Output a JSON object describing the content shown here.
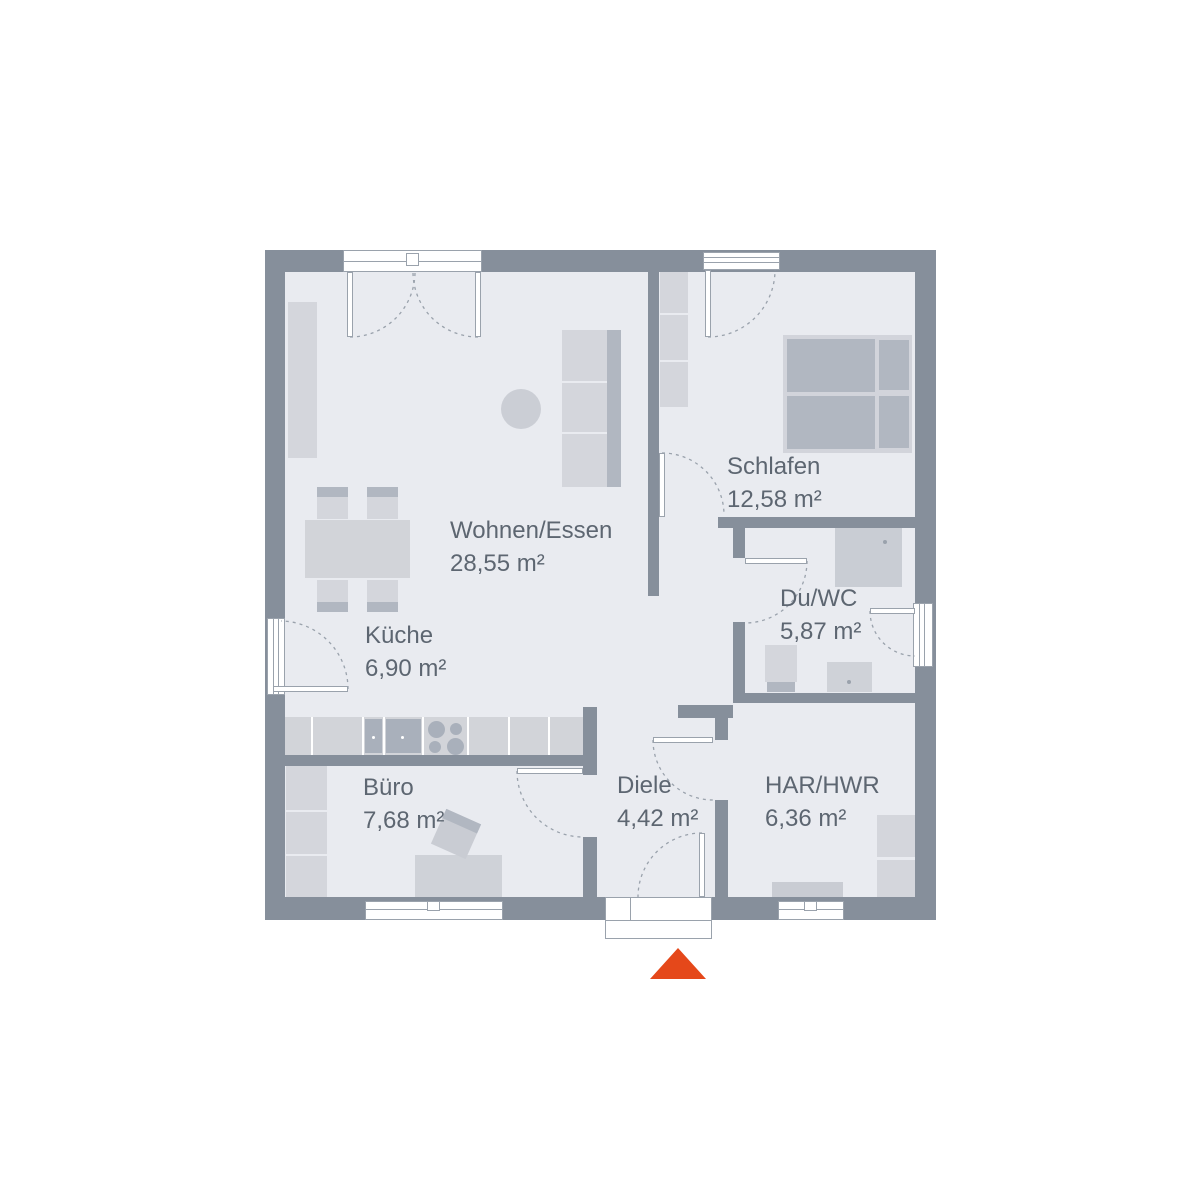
{
  "rooms": {
    "wohnen": {
      "name": "Wohnen/Essen",
      "area": "28,55 m²"
    },
    "schlafen": {
      "name": "Schlafen",
      "area": "12,58 m²"
    },
    "duwc": {
      "name": "Du/WC",
      "area": "5,87 m²"
    },
    "kueche": {
      "name": "Küche",
      "area": "6,90 m²"
    },
    "buero": {
      "name": "Büro",
      "area": "7,68 m²"
    },
    "diele": {
      "name": "Diele",
      "area": "4,42 m²"
    },
    "har": {
      "name": "HAR/HWR",
      "area": "6,36 m²"
    }
  },
  "entrance_marker": {
    "icon": "triangle-up-icon",
    "color": "#e5481a"
  },
  "colors": {
    "wall": "#868f9b",
    "floor": "#e9ebf0",
    "accent": "#e5481a",
    "text": "#5d6671",
    "furn-light": "#d4d6dc",
    "furn-mid": "#c9ccd3",
    "furn-dark": "#b1b7c1",
    "appl": "#a9b0bb",
    "line": "#9aa2ac"
  }
}
